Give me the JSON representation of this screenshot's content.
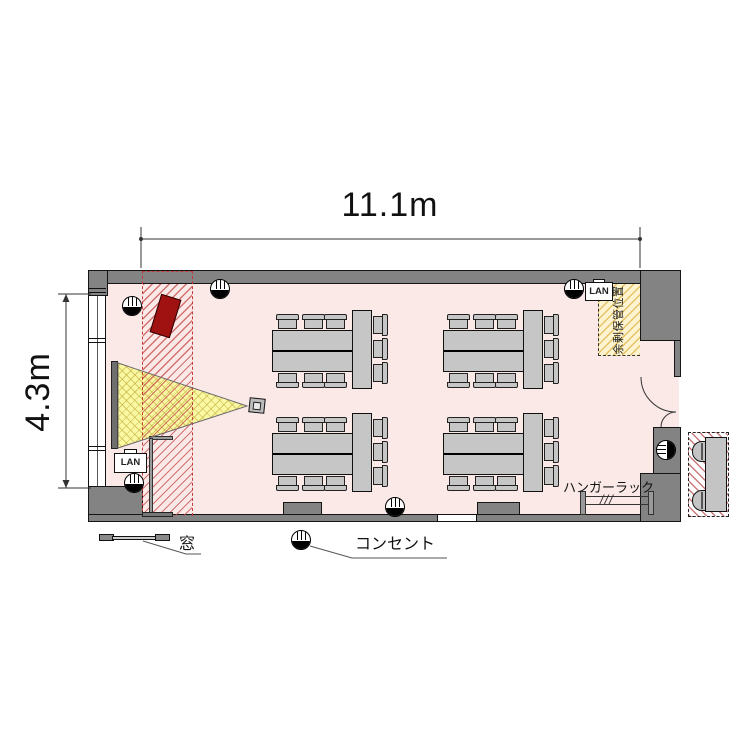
{
  "dimensions": {
    "width_label": "11.1m",
    "height_label": "4.3m"
  },
  "legend": {
    "window": "窓",
    "outlet": "コンセント"
  },
  "labels": {
    "hanger_rack": "ハンガーラック",
    "storage_zone": "余剰保管位置",
    "lan": "LAN",
    "rack_slashes": "///"
  },
  "room": {
    "table_islands": 4,
    "chairs_per_island": 9,
    "outside_stored_chairs": 2,
    "outlet_symbols_in_plan": 6
  },
  "colors": {
    "floor": "#fbe9e8",
    "wall": "#838383",
    "furniture": "#c6c6c6",
    "projection_beam": "#fbf8a4",
    "red_marker": "#a01212",
    "screen_zone_hatch": "#c95252",
    "storage_zone_fill": "#fdf3ce"
  }
}
